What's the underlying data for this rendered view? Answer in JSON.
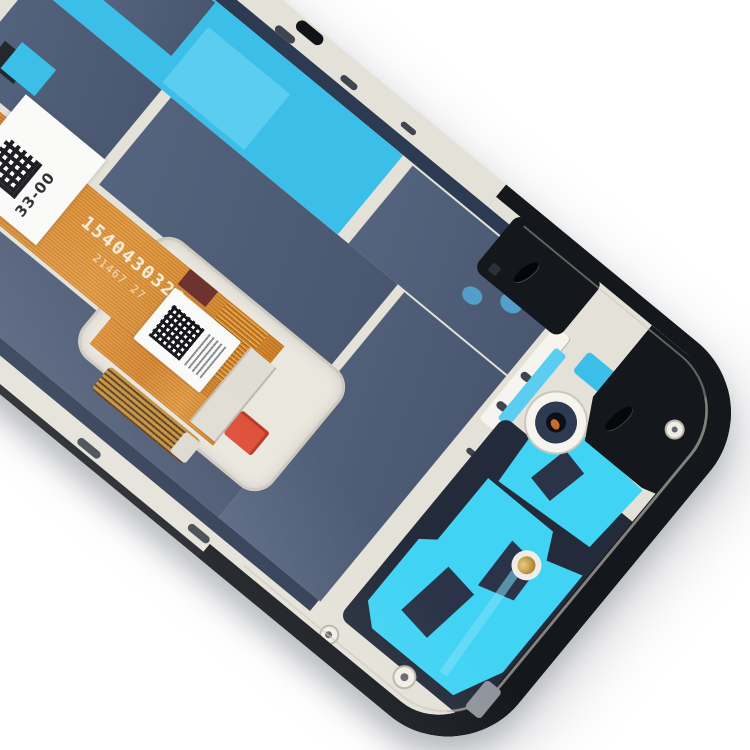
{
  "meta": {
    "description": "Product photo: back side of a smartphone LCD screen digitizer assembly with front housing frame, tilted diagonally on a white background"
  },
  "flex_cable": {
    "serial_number": "1540430320",
    "batch_code": "21467 27"
  },
  "stickers": {
    "frame_label_code": "33-00"
  },
  "theme": {
    "bg": "#ffffff",
    "silver": "#e4e1d8",
    "silver_hi": "#f6f4ee",
    "silver_sh": "#c8c4ba",
    "black_frame": "#14171c",
    "edge_black": "#1a1d23",
    "navy_strip": "#2c3a52",
    "slate": "#55647e",
    "slate_dk": "#48566f",
    "plate": "#232b3a",
    "cyan": "#3bbfe9",
    "cyan_lt": "#5bcdf1",
    "cyan_vivid": "#41d3f4",
    "drop": "#549fc9",
    "orange": "#d98a33",
    "red": "#dd4f38",
    "gold": "#c7a04a",
    "label": "#fafaf8"
  }
}
